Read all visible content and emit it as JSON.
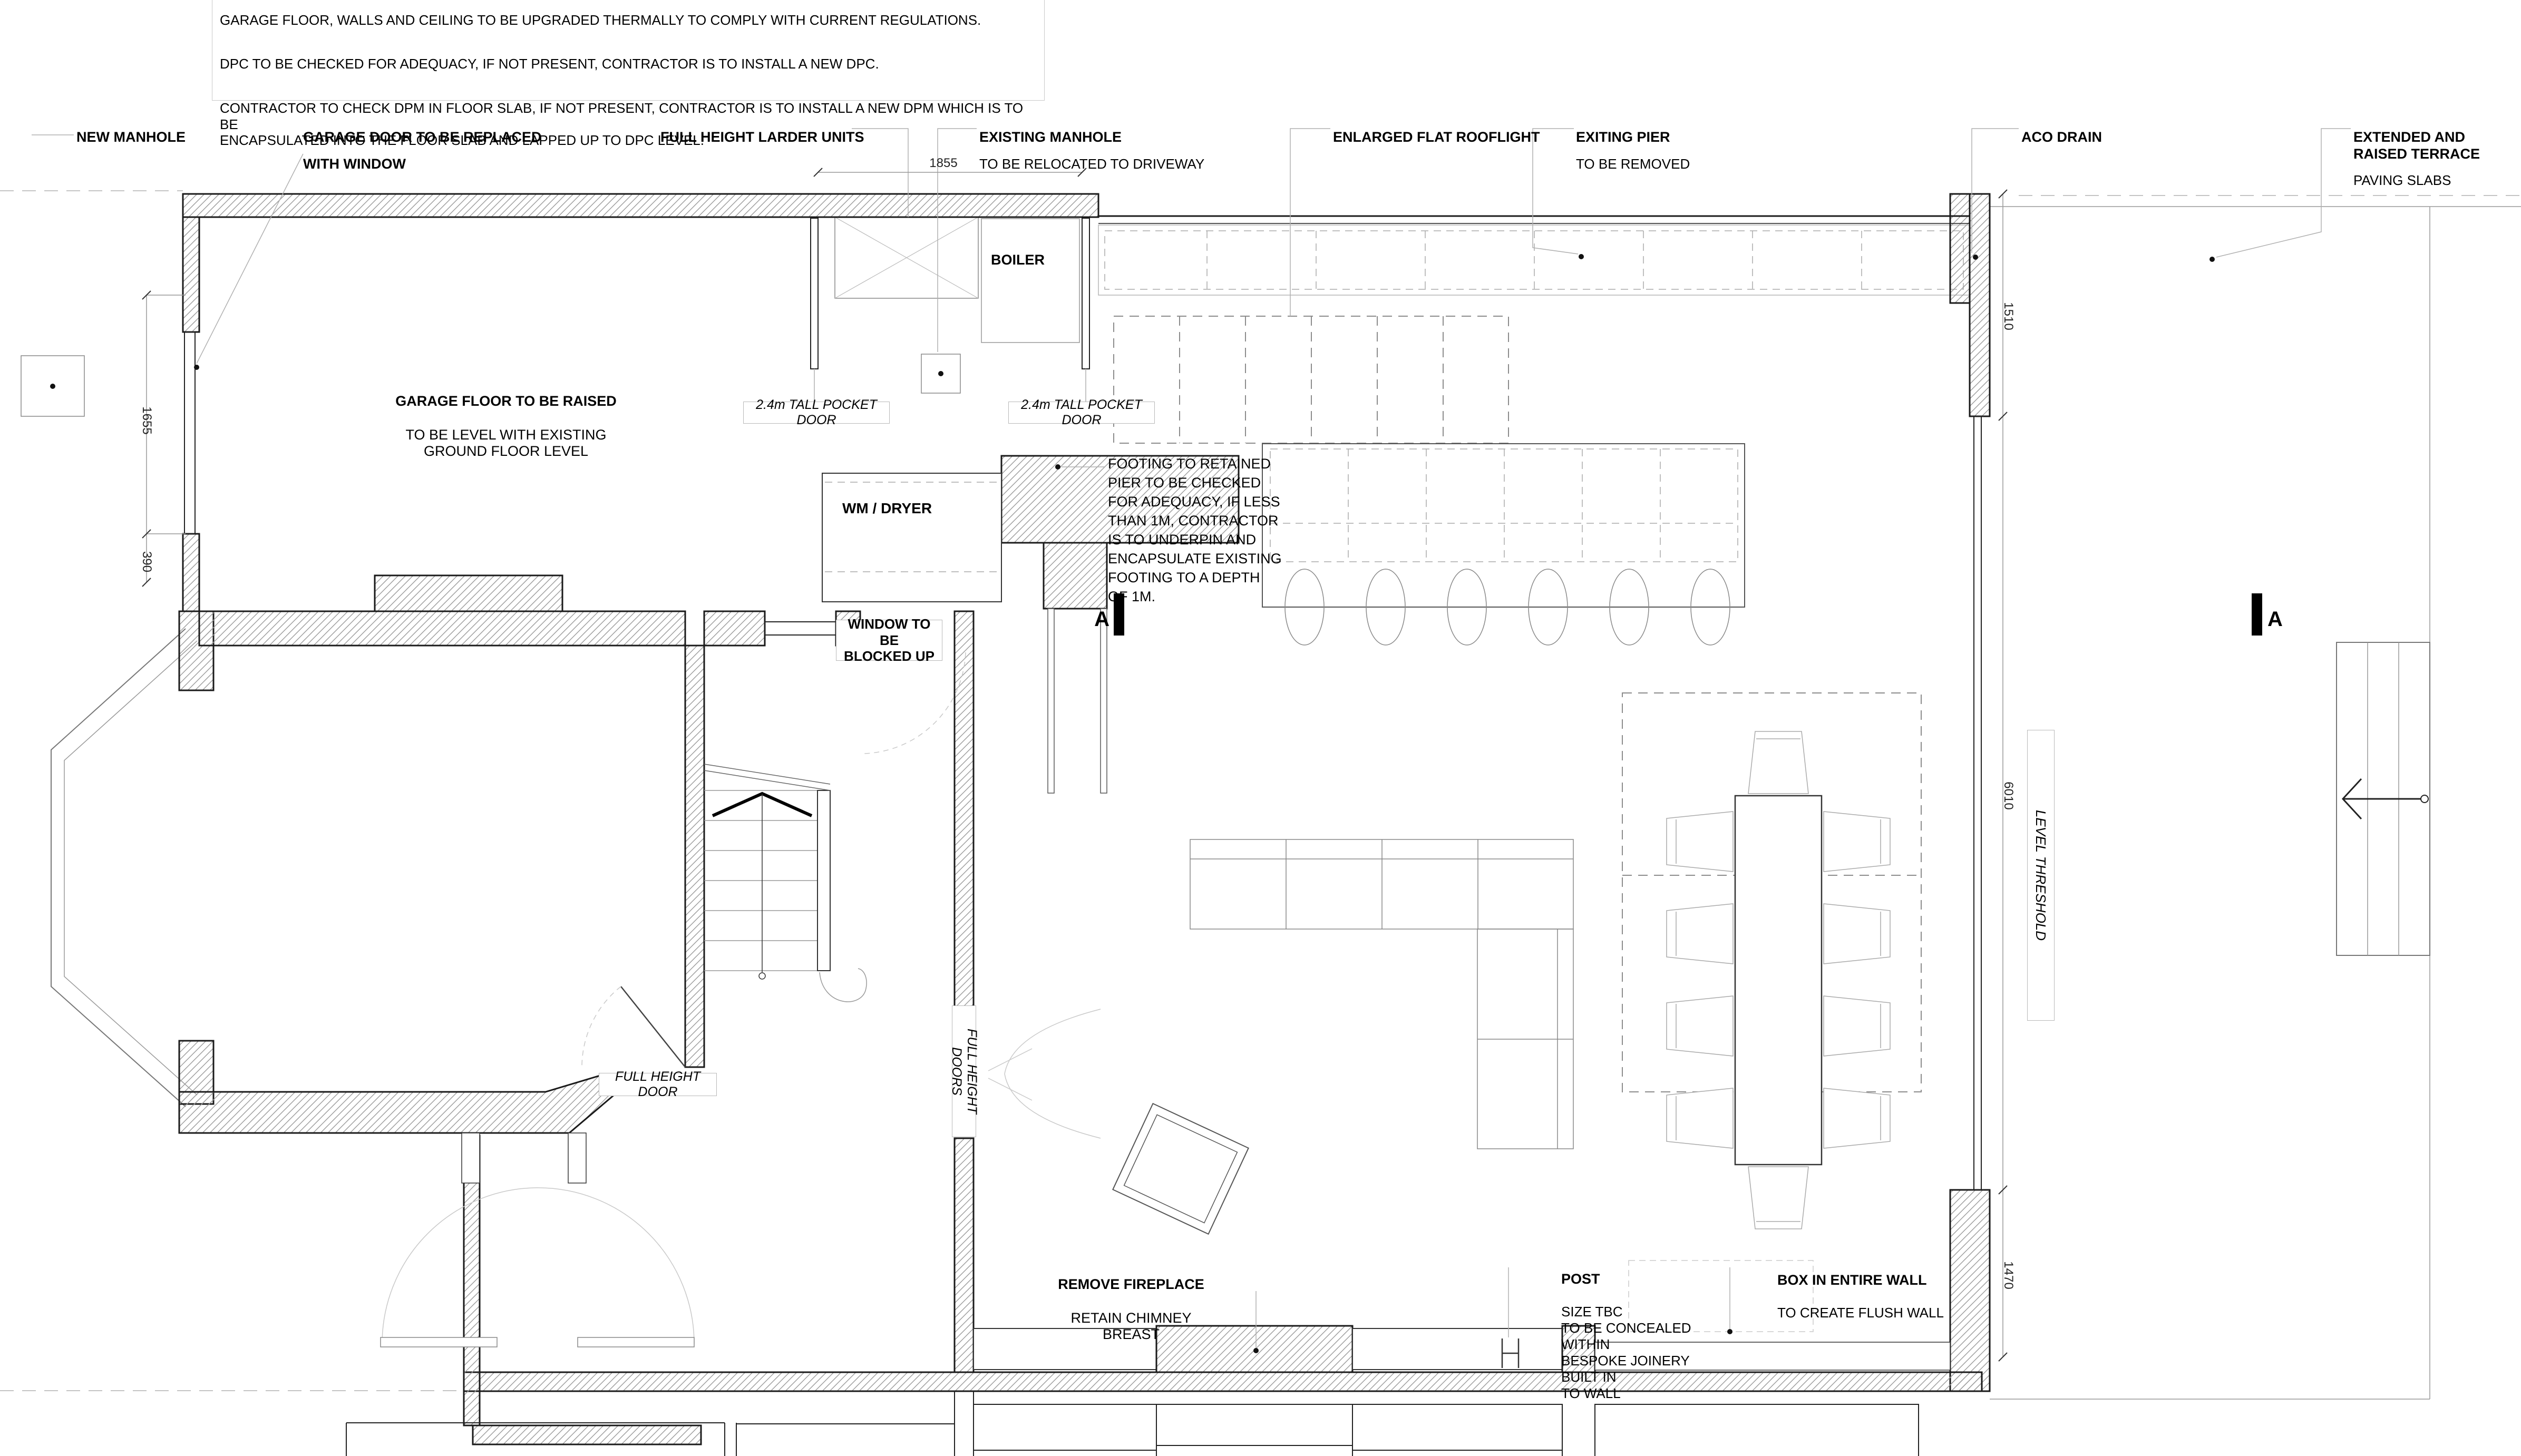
{
  "notes": {
    "line1": "GARAGE FLOOR, WALLS AND CEILING TO BE UPGRADED THERMALLY TO COMPLY WITH CURRENT REGULATIONS.",
    "line2": "DPC TO BE CHECKED FOR ADEQUACY, IF NOT PRESENT, CONTRACTOR IS TO INSTALL A NEW DPC.",
    "line3": "CONTRACTOR TO CHECK DPM IN FLOOR SLAB, IF NOT PRESENT, CONTRACTOR IS TO INSTALL A NEW DPM WHICH IS TO BE\nENCAPSULATED INTO THE FLOOR SLAB AND LAPPED UP TO DPC LEVEL."
  },
  "callouts": {
    "new_manhole": {
      "title": "NEW MANHOLE",
      "subtitle": ""
    },
    "garage_door": {
      "title": "GARAGE DOOR TO BE REPLACED",
      "subtitle": "WITH WINDOW"
    },
    "larder": {
      "title": "FULL HEIGHT LARDER UNITS",
      "subtitle": ""
    },
    "existing_manhole": {
      "title": "EXISTING MANHOLE",
      "subtitle": "TO BE RELOCATED TO DRIVEWAY"
    },
    "rooflight": {
      "title": "ENLARGED FLAT ROOFLIGHT",
      "subtitle": ""
    },
    "exiting_pier": {
      "title": "EXITING PIER",
      "subtitle": "TO BE REMOVED"
    },
    "aco_drain": {
      "title": "ACO DRAIN",
      "subtitle": ""
    },
    "terrace": {
      "title": "EXTENDED AND RAISED TERRACE",
      "subtitle": "PAVING SLABS"
    }
  },
  "rooms": {
    "garage": {
      "line1": "GARAGE FLOOR TO BE RAISED",
      "line2": "TO BE LEVEL WITH EXISTING\nGROUND FLOOR LEVEL"
    },
    "boiler": "BOILER",
    "wm_dryer": "WM / DRYER",
    "window_blocked": "WINDOW TO BE\nBLOCKED UP",
    "pocket_door": "2.4m TALL POCKET DOOR",
    "footing_note": "FOOTING TO RETAINED\nPIER TO BE CHECKED\nFOR ADEQUACY, IF LESS\nTHAN 1M, CONTRACTOR\nIS TO UNDERPIN AND\nENCAPSULATE EXISTING\nFOOTING TO A DEPTH\nOF 1M.",
    "full_height_door": "FULL HEIGHT DOOR",
    "full_height_doors": "FULL HEIGHT DOORS",
    "level_threshold": "LEVEL THRESHOLD",
    "remove_fireplace": {
      "title": "REMOVE FIREPLACE",
      "subtitle": "RETAIN CHIMNEY BREAST"
    },
    "post": {
      "title": "POST",
      "body": "SIZE TBC\nTO BE CONCEALED WITHIN\nBESPOKE JOINERY BUILT IN\nTO WALL"
    },
    "box_in": {
      "title": "BOX IN ENTIRE WALL",
      "subtitle": "TO CREATE FLUSH WALL"
    }
  },
  "dimensions": {
    "top": "1855",
    "left_upper": "1655",
    "left_lower": "390",
    "right_upper": "1510",
    "right_mid": "6010",
    "right_lower": "1470"
  },
  "section": {
    "label": "A"
  },
  "colors": {
    "line": "#1a1a1a",
    "hatch": "#999999",
    "leader": "#b0b0b0",
    "dashed": "#8c8c8c"
  }
}
